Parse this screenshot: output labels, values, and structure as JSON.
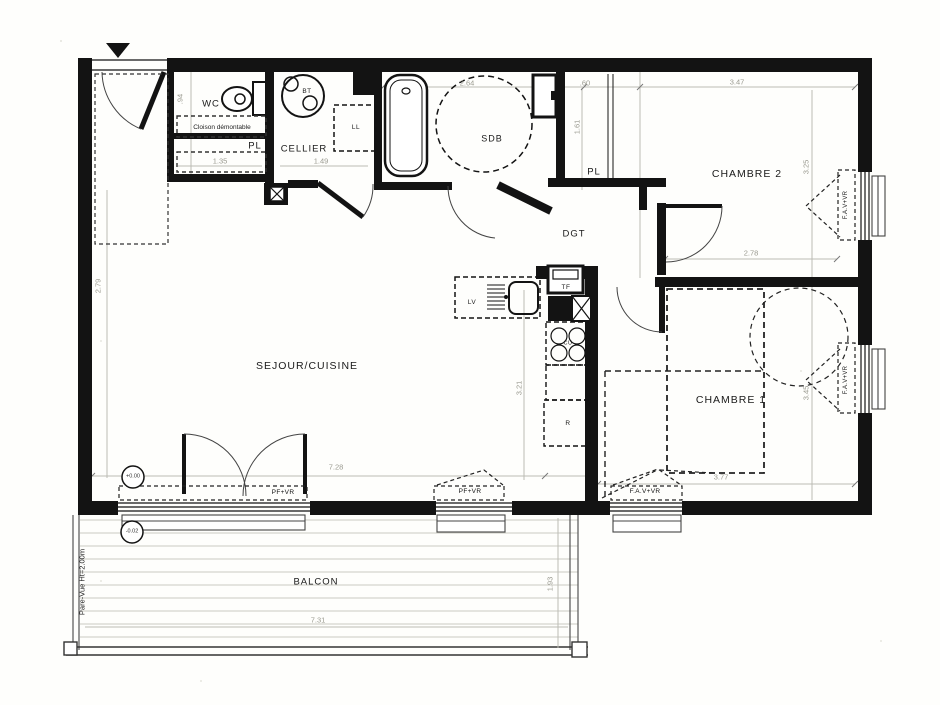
{
  "floorplan": {
    "type": "apartment-floor-plan",
    "colors": {
      "wall": "#131313",
      "dim_text": "#9a9a90",
      "light_line": "#c9c9c2"
    },
    "texts": [
      {
        "kind": "room",
        "text": "SEJOUR/CUISINE",
        "x": 307,
        "y": 366,
        "size": 10.5
      },
      {
        "kind": "room",
        "text": "CHAMBRE 2",
        "x": 747,
        "y": 174,
        "size": 10.5
      },
      {
        "kind": "room",
        "text": "CHAMBRE 1",
        "x": 731,
        "y": 400,
        "size": 10.5
      },
      {
        "kind": "room",
        "text": "SDB",
        "x": 492,
        "y": 139,
        "size": 9
      },
      {
        "kind": "room",
        "text": "DGT",
        "x": 574,
        "y": 234,
        "size": 9.5
      },
      {
        "kind": "room",
        "text": "CELLIER",
        "x": 304,
        "y": 149,
        "size": 9.5
      },
      {
        "kind": "room",
        "text": "WC",
        "x": 211,
        "y": 104,
        "size": 9.5
      },
      {
        "kind": "room",
        "text": "BALCON",
        "x": 316,
        "y": 582,
        "size": 9.5
      },
      {
        "kind": "room",
        "text": "PL",
        "x": 255,
        "y": 146,
        "size": 9.5
      },
      {
        "kind": "room",
        "text": "PL",
        "x": 594,
        "y": 172,
        "size": 9.5
      },
      {
        "kind": "fixture",
        "text": "LL",
        "x": 356,
        "y": 128,
        "size": 6.5
      },
      {
        "kind": "fixture",
        "text": "BT",
        "x": 307,
        "y": 92,
        "size": 6.5
      },
      {
        "kind": "fixture",
        "text": "LV",
        "x": 472,
        "y": 303,
        "size": 6.5
      },
      {
        "kind": "fixture",
        "text": "TF",
        "x": 566,
        "y": 288,
        "size": 6.5
      },
      {
        "kind": "fixture",
        "text": "CU",
        "x": 568,
        "y": 344,
        "size": 5.5
      },
      {
        "kind": "fixture",
        "text": "R",
        "x": 568,
        "y": 424,
        "size": 6.5
      },
      {
        "kind": "window",
        "text": "PF+VR",
        "x": 283,
        "y": 493,
        "size": 6.5
      },
      {
        "kind": "window",
        "text": "PF+VR",
        "x": 470,
        "y": 492,
        "size": 6.5
      },
      {
        "kind": "window",
        "text": "F.A.V+VR",
        "x": 645,
        "y": 492,
        "size": 6.5
      },
      {
        "kind": "window",
        "text": "F.A.V+VR",
        "x": 846,
        "y": 205,
        "size": 6,
        "rot": -90
      },
      {
        "kind": "window",
        "text": "F.A.V+VR",
        "x": 846,
        "y": 380,
        "size": 6,
        "rot": -90
      },
      {
        "kind": "annot",
        "text": "Cloison démontable",
        "x": 222,
        "y": 128,
        "size": 6.5
      },
      {
        "kind": "annot",
        "text": "Pare-Vue Ht=2.00m",
        "x": 82,
        "y": 582,
        "size": 7.5,
        "rot": -90
      },
      {
        "kind": "dim",
        "text": "2.64",
        "x": 467,
        "y": 83,
        "size": 7.5
      },
      {
        "kind": "dim",
        "text": ".60",
        "x": 585,
        "y": 83,
        "size": 7.5
      },
      {
        "kind": "dim",
        "text": "3.47",
        "x": 737,
        "y": 82,
        "size": 7.5
      },
      {
        "kind": "dim",
        "text": ".94",
        "x": 180,
        "y": 99,
        "size": 7.5,
        "rot": -90
      },
      {
        "kind": "dim",
        "text": "1.35",
        "x": 220,
        "y": 161,
        "size": 7.5
      },
      {
        "kind": "dim",
        "text": "1.49",
        "x": 321,
        "y": 161,
        "size": 7.5
      },
      {
        "kind": "dim",
        "text": "1.61",
        "x": 577,
        "y": 127,
        "size": 7.5,
        "rot": -90
      },
      {
        "kind": "dim",
        "text": "2.79",
        "x": 98,
        "y": 286,
        "size": 7.5,
        "rot": -90
      },
      {
        "kind": "dim",
        "text": "3.25",
        "x": 806,
        "y": 167,
        "size": 7.5,
        "rot": -90
      },
      {
        "kind": "dim",
        "text": "2.78",
        "x": 751,
        "y": 253,
        "size": 7.5
      },
      {
        "kind": "dim",
        "text": "3.21",
        "x": 519,
        "y": 388,
        "size": 7.5,
        "rot": -90
      },
      {
        "kind": "dim",
        "text": "7.28",
        "x": 336,
        "y": 467,
        "size": 7.5
      },
      {
        "kind": "dim",
        "text": "3.77",
        "x": 721,
        "y": 477,
        "size": 7.5
      },
      {
        "kind": "dim",
        "text": "3.45",
        "x": 806,
        "y": 393,
        "size": 7.5,
        "rot": -90
      },
      {
        "kind": "dim",
        "text": "7.31",
        "x": 318,
        "y": 620,
        "size": 7.5
      },
      {
        "kind": "dim",
        "text": "1.93",
        "x": 550,
        "y": 584,
        "size": 7.5,
        "rot": -90
      },
      {
        "kind": "level",
        "text": "+0.00",
        "x": 133,
        "y": 477,
        "size": 5.5
      },
      {
        "kind": "level",
        "text": "-0.02",
        "x": 132,
        "y": 532,
        "size": 5.5
      }
    ]
  }
}
